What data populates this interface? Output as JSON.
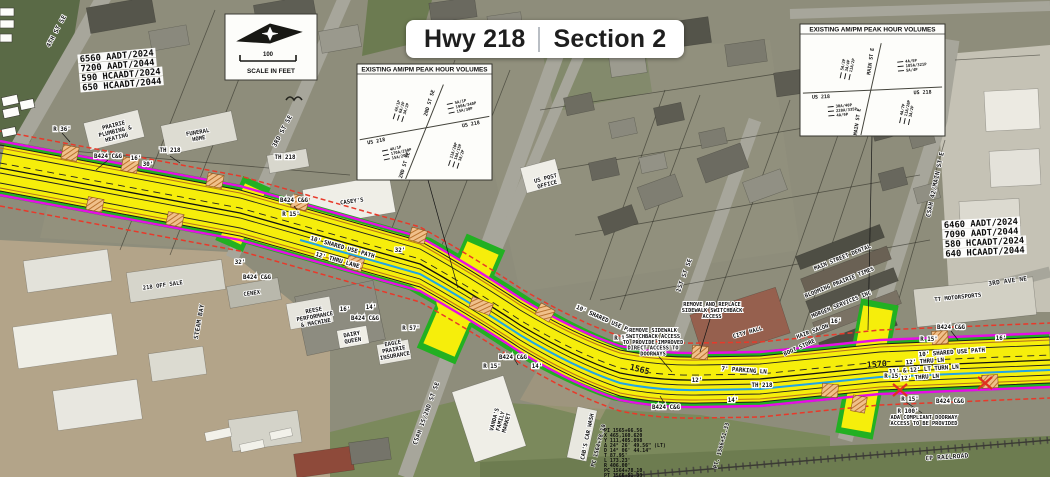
{
  "title": {
    "left": "Hwy 218",
    "right": "Section 2"
  },
  "scale": {
    "distance_label": "100",
    "caption": "SCALE IN FEET"
  },
  "aadt_blocks": [
    {
      "x": 80,
      "y": 62,
      "rot": -5,
      "lines": [
        "6560 AADT/2024",
        "7200 AADT/2044",
        "590 HCAADT/2024",
        "650 HCAADT/2044"
      ]
    },
    {
      "x": 944,
      "y": 228,
      "rot": -3,
      "lines": [
        "6460 AADT/2024",
        "7090 AADT/2044",
        "580 HCAADT/2024",
        "640 HCAADT/2044"
      ]
    }
  ],
  "curve_table": {
    "x": 604,
    "y": 432,
    "lines": [
      "PI 1565+66.56",
      "X 465,160.620",
      "Y 111,405.098",
      "Δ 24° 26' 49.56\" (LT)",
      "D 14° 06' 44.14\"",
      "T 87.95'",
      "L 173.23'",
      "R 406.00'",
      "PC 1564+78.10",
      "PT 1566+51.33"
    ]
  },
  "volume_boxes": [
    {
      "x": 357,
      "y": 64,
      "w": 135,
      "h": 116,
      "header": "EXISTING AM/PM PEAK HOUR VOLUMES",
      "ew_road": "US 218",
      "ns_road": "2ND ST SE",
      "movements": [
        {
          "quadrant": "nw",
          "rot": -72,
          "values": [
            "4A/1P",
            "6A/2P",
            "3A/2P"
          ]
        },
        {
          "quadrant": "ne",
          "rot": -12,
          "values": [
            "5A/1P",
            "190A/340P",
            "15A/30P"
          ]
        },
        {
          "quadrant": "sw",
          "rot": -12,
          "values": [
            "4A/1P",
            "170A/250P",
            "15A/20P"
          ]
        },
        {
          "quadrant": "se",
          "rot": -72,
          "values": [
            "11A/20P",
            "16A/15P",
            "3A/2P"
          ]
        }
      ]
    },
    {
      "x": 800,
      "y": 24,
      "w": 145,
      "h": 112,
      "header": "EXISTING AM/PM PEAK HOUR VOLUMES",
      "ew_road": "US 218",
      "ns_road": "MAIN ST E",
      "movements": [
        {
          "quadrant": "nw",
          "rot": -78,
          "values": [
            "5A/2P",
            "3A/4P",
            "11A/2P"
          ]
        },
        {
          "quadrant": "ne",
          "rot": -5,
          "values": [
            "4A/5P",
            "185A/321P",
            "5A/4P"
          ]
        },
        {
          "quadrant": "sw",
          "rot": -5,
          "values": [
            "30A/40P",
            "220A/335P",
            "4A/9P"
          ]
        },
        {
          "quadrant": "se",
          "rot": -78,
          "values": [
            "4A/7P",
            "11A/20P",
            "3A/2P"
          ]
        }
      ]
    }
  ],
  "map_labels": [
    {
      "kind": "street",
      "name": "street-4th-st-se",
      "text": "4TH ST SE",
      "x": 58,
      "y": 32,
      "rot": -62
    },
    {
      "kind": "street",
      "name": "street-3rd-st-se",
      "text": "3RD ST SE",
      "x": 284,
      "y": 132,
      "rot": -62
    },
    {
      "kind": "street",
      "name": "street-steam-bay",
      "text": "STEAM BAY",
      "x": 201,
      "y": 322,
      "rot": -80
    },
    {
      "kind": "street",
      "name": "street-csah15-2nd-st-se",
      "text": "CSAH 15/2ND ST SE",
      "x": 428,
      "y": 414,
      "rot": -70
    },
    {
      "kind": "street",
      "name": "street-1st-st-se",
      "text": "1ST ST SE",
      "x": 686,
      "y": 276,
      "rot": -70
    },
    {
      "kind": "street",
      "name": "street-csah42-main-st-e",
      "text": "CSAH 42/MAIN ST E",
      "x": 937,
      "y": 185,
      "rot": -78
    },
    {
      "kind": "street",
      "name": "street-3rd-ave-ne",
      "text": "3RD AVE NE",
      "x": 1008,
      "y": 283,
      "rot": -8
    },
    {
      "kind": "street",
      "name": "label-cp-railroad",
      "text": "CP RAILROAD",
      "x": 947,
      "y": 459,
      "rot": -4
    },
    {
      "kind": "building",
      "name": "bldg-prairie-plumbing",
      "lines": [
        "PRAIRIE",
        "PLUMBING &",
        "HEATING"
      ],
      "x": 114,
      "y": 127,
      "rot": -14
    },
    {
      "kind": "building",
      "name": "bldg-funeral-home",
      "lines": [
        "FUNERAL",
        "HOME"
      ],
      "x": 198,
      "y": 134,
      "rot": -10
    },
    {
      "kind": "building",
      "name": "bldg-caseys",
      "text": "CASEY'S",
      "x": 352,
      "y": 203,
      "rot": -8
    },
    {
      "kind": "building",
      "name": "bldg-us-post-office",
      "lines": [
        "US POST",
        "OFFICE"
      ],
      "x": 546,
      "y": 180,
      "rot": -15
    },
    {
      "kind": "building",
      "name": "bldg-218-off-sale",
      "text": "218 OFF SALE",
      "x": 163,
      "y": 287,
      "rot": -8
    },
    {
      "kind": "building",
      "name": "bldg-cenex",
      "text": "CENEX",
      "x": 252,
      "y": 295,
      "rot": -8
    },
    {
      "kind": "building",
      "name": "bldg-reese",
      "lines": [
        "REESE",
        "PERFORMANCE",
        "& MACHINE"
      ],
      "x": 314,
      "y": 312,
      "rot": -10
    },
    {
      "kind": "building",
      "name": "bldg-dairy-queen",
      "lines": [
        "DAIRY",
        "QUEEN"
      ],
      "x": 352,
      "y": 336,
      "rot": -10
    },
    {
      "kind": "building",
      "name": "bldg-eagle-prairie",
      "lines": [
        "EAGLE",
        "PRAIRIE",
        "INSURANCE"
      ],
      "x": 393,
      "y": 345,
      "rot": -10
    },
    {
      "kind": "building",
      "name": "bldg-family-market",
      "lines": [
        "VANDA'S",
        "FAMILY",
        "MARKET"
      ],
      "x": 496,
      "y": 420,
      "rot": -75
    },
    {
      "kind": "building",
      "name": "bldg-cabs-car-wash",
      "text": "CAB'S CAR WASH",
      "x": 589,
      "y": 437,
      "rot": -78
    },
    {
      "kind": "building",
      "name": "bldg-city-hall",
      "text": "CITY HALL",
      "x": 748,
      "y": 334,
      "rot": -16
    },
    {
      "kind": "building",
      "name": "bldg-main-street-dental",
      "text": "MAIN STREET DENTAL",
      "x": 843,
      "y": 259,
      "rot": -22
    },
    {
      "kind": "building",
      "name": "bldg-blooming-prairie-times",
      "text": "BLOOMING PRAIRIE TIMES",
      "x": 840,
      "y": 284,
      "rot": -22
    },
    {
      "kind": "building",
      "name": "bldg-morgen-services",
      "text": "MORGEN SERVICES INC",
      "x": 842,
      "y": 306,
      "rot": -22
    },
    {
      "kind": "building",
      "name": "bldg-hair-salon",
      "text": "HAIR SALON",
      "x": 813,
      "y": 333,
      "rot": -20
    },
    {
      "kind": "building",
      "name": "bldg-boot-store",
      "text": "BOOT STORE",
      "x": 800,
      "y": 349,
      "rot": -24
    },
    {
      "kind": "building",
      "name": "bldg-tt-motorsports",
      "text": "TT MOTORSPORTS",
      "x": 958,
      "y": 299,
      "rot": -6
    },
    {
      "kind": "callout",
      "text": "R 36'",
      "x": 62,
      "y": 131
    },
    {
      "kind": "callout",
      "text": "B424 C&G",
      "x": 108,
      "y": 158
    },
    {
      "kind": "callout",
      "text": "16'",
      "x": 136,
      "y": 160
    },
    {
      "kind": "callout",
      "text": "TH 218",
      "x": 170,
      "y": 152
    },
    {
      "kind": "callout",
      "text": "30'",
      "x": 148,
      "y": 166
    },
    {
      "kind": "callout",
      "text": "TH 218",
      "x": 285,
      "y": 159
    },
    {
      "kind": "callout",
      "text": "B424 C&G",
      "x": 294,
      "y": 202
    },
    {
      "kind": "callout",
      "text": "R 15'",
      "x": 291,
      "y": 216
    },
    {
      "kind": "callout",
      "text": "32'",
      "x": 240,
      "y": 264
    },
    {
      "kind": "callout",
      "text": "B424 C&G",
      "x": 257,
      "y": 279
    },
    {
      "kind": "callout",
      "text": "10' SHARED USE PATH",
      "x": 342,
      "y": 249,
      "rot": 16
    },
    {
      "kind": "callout",
      "text": "12' THRU LANE",
      "x": 337,
      "y": 262,
      "rot": 16
    },
    {
      "kind": "callout",
      "text": "32'",
      "x": 400,
      "y": 252
    },
    {
      "kind": "callout",
      "text": "16'",
      "x": 345,
      "y": 311
    },
    {
      "kind": "callout",
      "text": "14'",
      "x": 371,
      "y": 309
    },
    {
      "kind": "callout",
      "text": "B424 C&G",
      "x": 365,
      "y": 320
    },
    {
      "kind": "callout",
      "text": "R 57'",
      "x": 411,
      "y": 330
    },
    {
      "kind": "callout",
      "text": "B424 C&G",
      "x": 513,
      "y": 359
    },
    {
      "kind": "callout",
      "text": "R 15'",
      "x": 492,
      "y": 368
    },
    {
      "kind": "callout",
      "text": "14'",
      "x": 537,
      "y": 368
    },
    {
      "kind": "callout",
      "text": "10' SHARED USE PATH",
      "x": 606,
      "y": 322,
      "rot": 24
    },
    {
      "kind": "callout",
      "text": "R 15'",
      "x": 623,
      "y": 340
    },
    {
      "kind": "station",
      "name": "station-1565",
      "text": "1565",
      "x": 639,
      "y": 372,
      "rot": 14
    },
    {
      "kind": "callout",
      "text": "7' PARKING LN",
      "x": 744,
      "y": 372,
      "rot": 4
    },
    {
      "kind": "callout",
      "text": "TH 218",
      "x": 762,
      "y": 387
    },
    {
      "kind": "callout",
      "text": "12'",
      "x": 697,
      "y": 382
    },
    {
      "kind": "callout",
      "text": "16'",
      "x": 836,
      "y": 323
    },
    {
      "kind": "callout",
      "text": "B424 C&G",
      "x": 666,
      "y": 409
    },
    {
      "kind": "callout",
      "text": "14'",
      "x": 733,
      "y": 402
    },
    {
      "kind": "callout",
      "text": "R 15'",
      "x": 929,
      "y": 341
    },
    {
      "kind": "callout",
      "text": "16'",
      "x": 1001,
      "y": 340
    },
    {
      "kind": "callout",
      "text": "B424 C&G",
      "x": 951,
      "y": 329
    },
    {
      "kind": "callout",
      "text": "10' SHARED USE PATH",
      "x": 952,
      "y": 354,
      "rot": -4
    },
    {
      "kind": "callout",
      "text": "12' THRU LN",
      "x": 925,
      "y": 363,
      "rot": -4
    },
    {
      "kind": "callout",
      "text": "11' & 12' LT TURN LN",
      "x": 924,
      "y": 371,
      "rot": -4
    },
    {
      "kind": "callout",
      "text": "12' THRU LN",
      "x": 920,
      "y": 379,
      "rot": -4
    },
    {
      "kind": "callout",
      "text": "R 15'",
      "x": 893,
      "y": 378
    },
    {
      "kind": "callout",
      "text": "R 15'",
      "x": 910,
      "y": 401
    },
    {
      "kind": "callout",
      "text": "B424 C&G",
      "x": 950,
      "y": 403
    },
    {
      "kind": "callout",
      "text": "R 100'",
      "x": 908,
      "y": 413
    },
    {
      "kind": "station",
      "name": "station-1570",
      "text": "1570",
      "x": 877,
      "y": 367,
      "rot": -4
    },
    {
      "kind": "note",
      "name": "note-remove-replace-switchback",
      "lines": [
        "REMOVE AND REPLACE",
        "SIDEWALK SWITCHBACK",
        "ACCESS"
      ],
      "x": 712,
      "y": 306
    },
    {
      "kind": "note",
      "name": "note-remove-switchback-doorways",
      "lines": [
        "REMOVE SIDEWALK",
        "SWITCHBACK ACCESS",
        "TO PROVIDE IMPROVED",
        "DIRECT ACCESS TO",
        "DOORWAYS"
      ],
      "x": 653,
      "y": 332
    },
    {
      "kind": "note",
      "name": "note-ada-doorway",
      "lines": [
        "ADA COMPLIANT DOORWAY",
        "ACCESS TO BE PROVIDED"
      ],
      "x": 924,
      "y": 419
    },
    {
      "kind": "vstation",
      "name": "station-pc",
      "text": "PC 1564+78.10",
      "x": 600,
      "y": 446,
      "rot": -75
    },
    {
      "kind": "vstation",
      "name": "station-pt",
      "text": "PT. 1566+51.33",
      "x": 723,
      "y": 446,
      "rot": -75
    }
  ]
}
